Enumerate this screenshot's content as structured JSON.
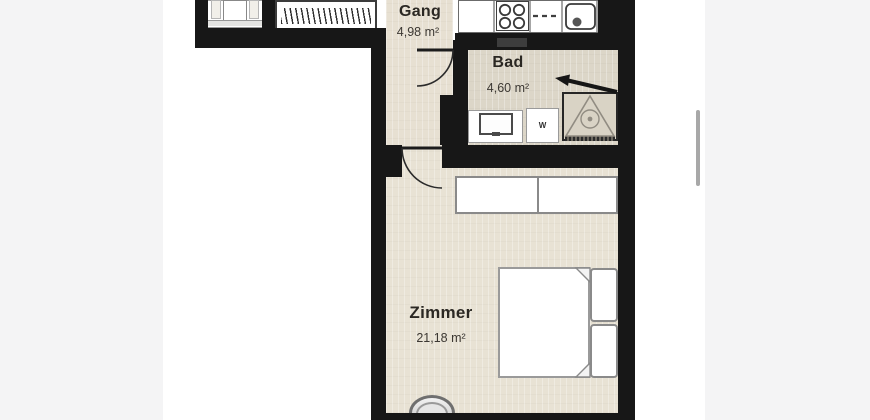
{
  "page": {
    "side_background": "#f4f4f5",
    "canvas_background": "#ffffff",
    "scrollbar_color": "#a8a8a8"
  },
  "floorplan": {
    "type": "apartment-floor-plan",
    "rooms": {
      "gang": {
        "name": "Gang",
        "area": "4,98 m²"
      },
      "bad": {
        "name": "Bad",
        "area": "4,60 m²"
      },
      "zimmer": {
        "name": "Zimmer",
        "area": "21,18 m²"
      }
    },
    "fixtures": {
      "washing_machine_label": "W"
    },
    "colors": {
      "wall": "#171717",
      "floor_gang": "#e7e0d2",
      "floor_bad": "#dcd6c8",
      "floor_zimmer": "#e8e2d4",
      "floor_entry": "#d9d2c4",
      "label_text": "#2b2823"
    }
  }
}
